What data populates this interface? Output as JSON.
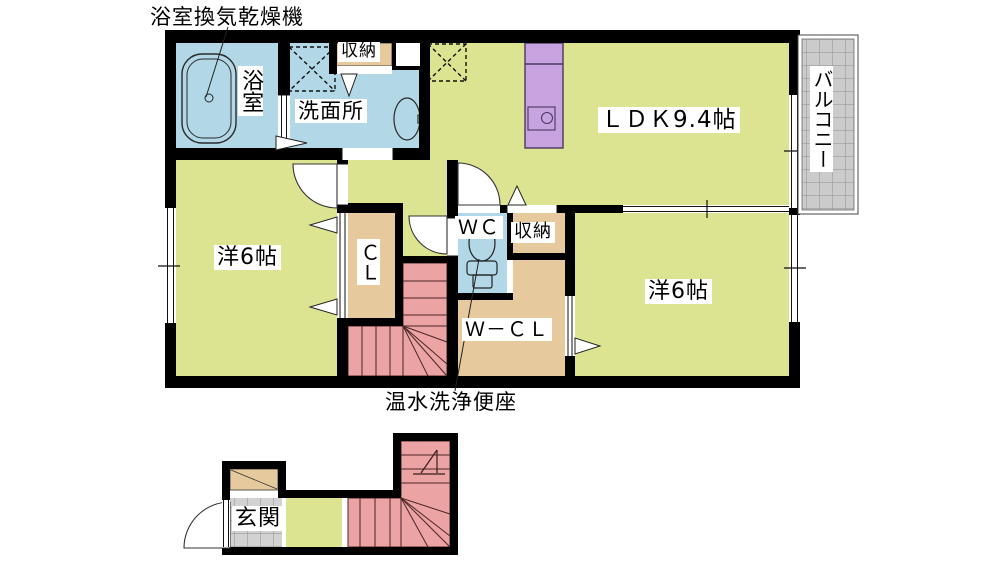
{
  "colors": {
    "wall": "#000000",
    "room_yellow": "#dde491",
    "water_blue": "#b2d7e6",
    "closet_beige": "#e6ca9d",
    "stair_pink": "#eca3a3",
    "kitchen_purple": "#c7a3df",
    "balcony_gray": "#cbcbcb",
    "grid_line": "#8f8f8f",
    "tile_gray": "#d2d2d2"
  },
  "floor2": {
    "annotations": {
      "vent_dryer": "浴室換気乾燥機",
      "toilet_note": "温水洗浄便座"
    },
    "rooms": {
      "bathroom": "浴室",
      "washroom": "洗面所",
      "storage_top": "収納",
      "ldk": "ＬＤＫ9.4帖",
      "balcony": "バルコニー",
      "west_room": "洋6帖",
      "closet": "ＣＬ",
      "wc": "ＷＣ",
      "storage_right": "収納",
      "walkin_closet": "Ｗ－ＣＬ",
      "east_room": "洋6帖"
    }
  },
  "floor1": {
    "rooms": {
      "entrance": "玄関"
    }
  }
}
